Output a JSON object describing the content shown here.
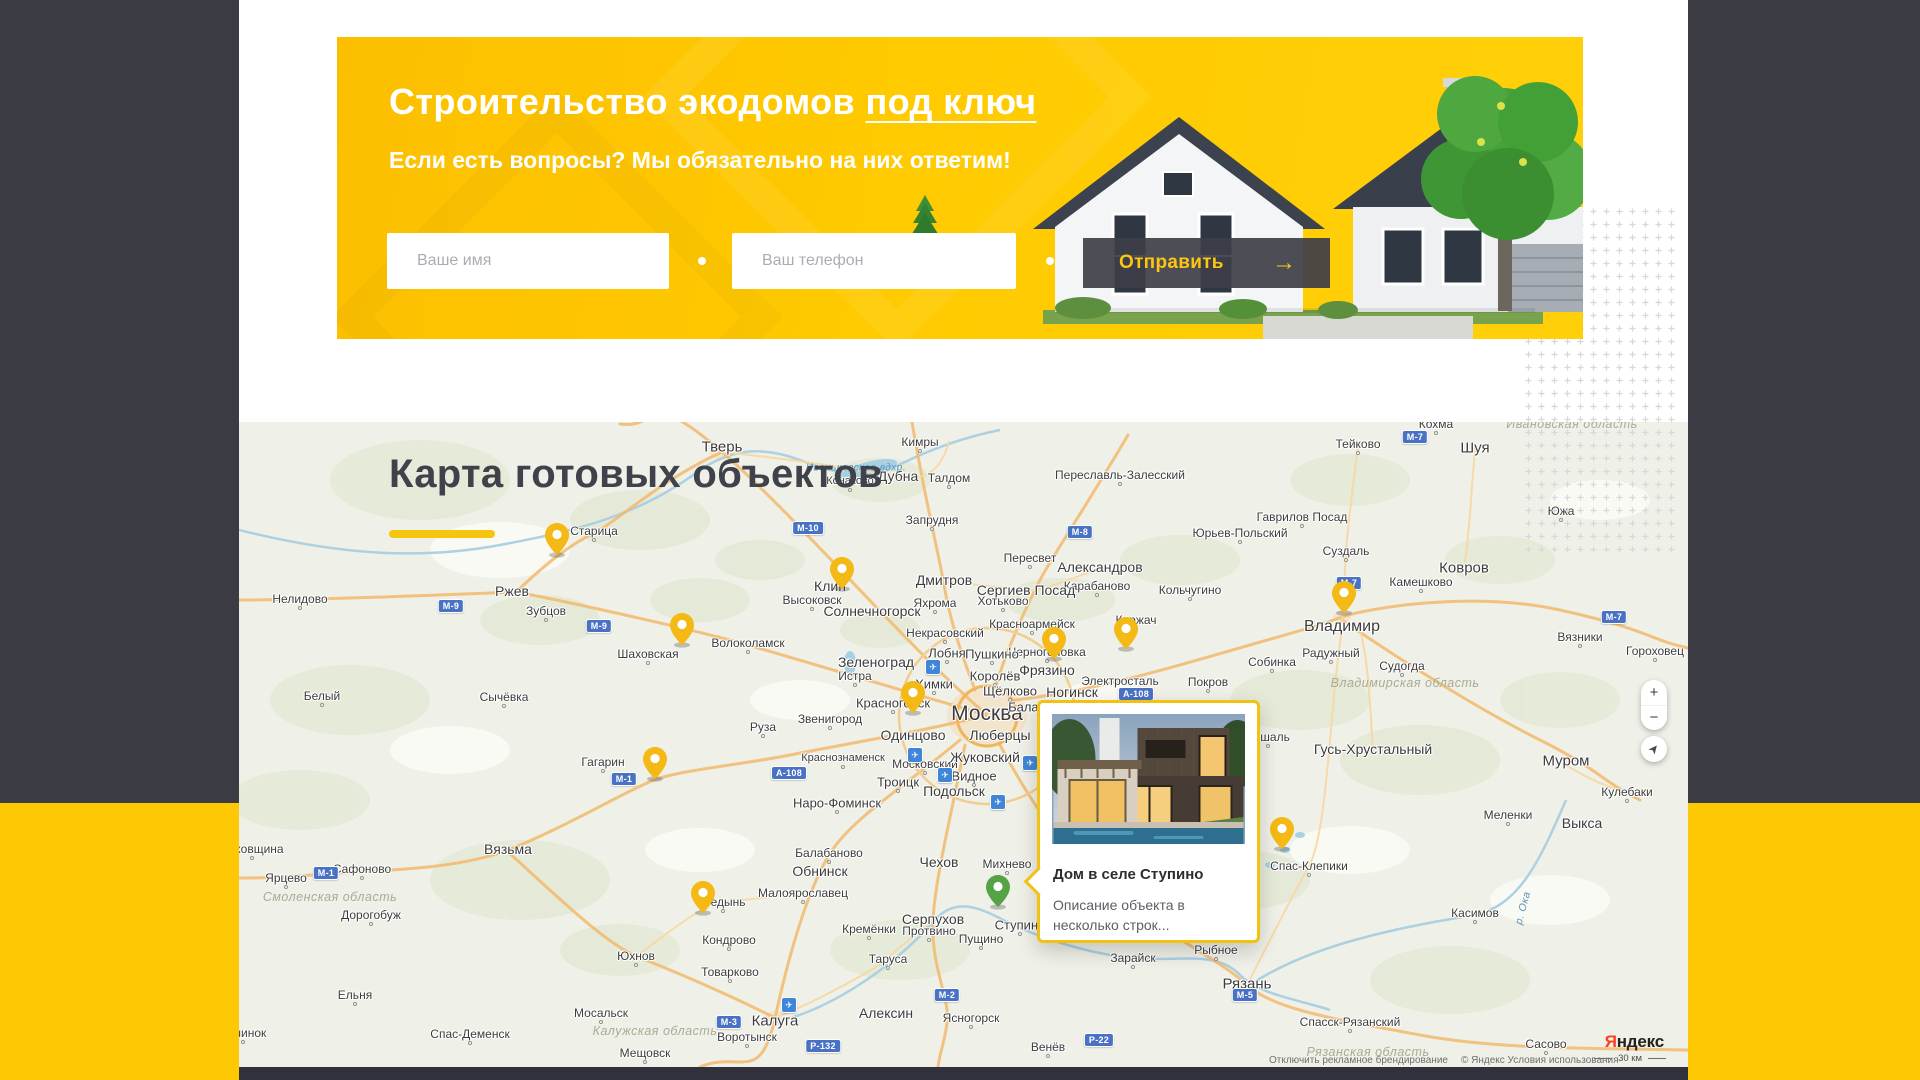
{
  "colors": {
    "accent_yellow": "#fdc400",
    "pin_yellow": "#f5b915",
    "pin_green": "#55a345",
    "dark": "#3a3b43",
    "button_dark": "#3e3e48"
  },
  "banner": {
    "title_prefix": "Строительство экодомов ",
    "title_underlined": "под ключ",
    "subtitle": "Если есть вопросы? Мы обязательно на них ответим!",
    "name_placeholder": "Ваше имя",
    "phone_placeholder": "Ваш телефон",
    "submit_label": "Отправить",
    "submit_arrow": "→"
  },
  "map_section": {
    "title": "Карта готовых объектов",
    "popup": {
      "title": "Дом в селе Ступино",
      "description": "Описание объекта в несколько строк..."
    },
    "controls": {
      "zoom_in": "+",
      "zoom_out": "−"
    },
    "attribution": {
      "branding": "Отключить рекламное брендирование",
      "terms": "© Яндекс Условия использования",
      "scale": "30 км",
      "logo_first": "Я",
      "logo_rest": "ндекс"
    },
    "cities": [
      {
        "t": "Тверь",
        "x": 722,
        "y": 447,
        "s": 15
      },
      {
        "t": "Кимры",
        "x": 920,
        "y": 442
      },
      {
        "t": "Дубна",
        "x": 898,
        "y": 476,
        "s": 14
      },
      {
        "t": "Талдом",
        "x": 949,
        "y": 478
      },
      {
        "t": "Конаково",
        "x": 850,
        "y": 481,
        "s": 11
      },
      {
        "t": "Запрудня",
        "x": 932,
        "y": 520
      },
      {
        "t": "Переславль-Залесский",
        "x": 1120,
        "y": 475
      },
      {
        "t": "Пересвет",
        "x": 1030,
        "y": 558
      },
      {
        "t": "Александров",
        "x": 1100,
        "y": 567,
        "s": 14
      },
      {
        "t": "Карабаново",
        "x": 1097,
        "y": 586
      },
      {
        "t": "Кольчугино",
        "x": 1190,
        "y": 590
      },
      {
        "t": "Юрьев-Польский",
        "x": 1240,
        "y": 533
      },
      {
        "t": "Киржач",
        "x": 1136,
        "y": 620
      },
      {
        "t": "Дмитров",
        "x": 944,
        "y": 580,
        "s": 14
      },
      {
        "t": "Сергиев Посад",
        "x": 1026,
        "y": 590,
        "s": 14
      },
      {
        "t": "Хотьково",
        "x": 1003,
        "y": 601
      },
      {
        "t": "Яхрома",
        "x": 935,
        "y": 603
      },
      {
        "t": "Высоковск",
        "x": 812,
        "y": 600
      },
      {
        "t": "Клин",
        "x": 830,
        "y": 586,
        "s": 14
      },
      {
        "t": "Солнечногорск",
        "x": 872,
        "y": 611,
        "s": 14
      },
      {
        "t": "Некрасовский",
        "x": 945,
        "y": 633
      },
      {
        "t": "Красноармейск",
        "x": 1032,
        "y": 624
      },
      {
        "t": "Черноголовка",
        "x": 1047,
        "y": 652
      },
      {
        "t": "Лобня",
        "x": 947,
        "y": 653,
        "s": 13
      },
      {
        "t": "Пушкино",
        "x": 992,
        "y": 654,
        "s": 13
      },
      {
        "t": "Фрязино",
        "x": 1047,
        "y": 670,
        "s": 14
      },
      {
        "t": "Зеленоград",
        "x": 876,
        "y": 662,
        "s": 14
      },
      {
        "t": "Истра",
        "x": 855,
        "y": 676
      },
      {
        "t": "Химки",
        "x": 934,
        "y": 684,
        "s": 13
      },
      {
        "t": "Королёв",
        "x": 995,
        "y": 676,
        "s": 13
      },
      {
        "t": "Щёлково",
        "x": 1010,
        "y": 691,
        "s": 13
      },
      {
        "t": "Ногинск",
        "x": 1072,
        "y": 692,
        "s": 14
      },
      {
        "t": "Электросталь",
        "x": 1120,
        "y": 681
      },
      {
        "t": "Покров",
        "x": 1208,
        "y": 682
      },
      {
        "t": "Красногорск",
        "x": 893,
        "y": 703,
        "s": 13
      },
      {
        "t": "Москва",
        "x": 987,
        "y": 714,
        "s": 21
      },
      {
        "t": "Звенигород",
        "x": 830,
        "y": 719
      },
      {
        "t": "Одинцово",
        "x": 913,
        "y": 735,
        "s": 14
      },
      {
        "t": "Люберцы",
        "x": 1000,
        "y": 735,
        "s": 14
      },
      {
        "t": "Балашиха",
        "x": 1039,
        "y": 707,
        "s": 13
      },
      {
        "t": "Краснознаменск",
        "x": 843,
        "y": 758,
        "s": 11
      },
      {
        "t": "Московский",
        "x": 925,
        "y": 764
      },
      {
        "t": "Жуковский",
        "x": 985,
        "y": 757,
        "s": 14
      },
      {
        "t": "Видное",
        "x": 974,
        "y": 776,
        "s": 13
      },
      {
        "t": "Троицк",
        "x": 898,
        "y": 782,
        "s": 13
      },
      {
        "t": "Подольск",
        "x": 954,
        "y": 791,
        "s": 14
      },
      {
        "t": "Наро-Фоминск",
        "x": 837,
        "y": 803,
        "s": 13
      },
      {
        "t": "Руза",
        "x": 763,
        "y": 727
      },
      {
        "t": "Волоколамск",
        "x": 748,
        "y": 643
      },
      {
        "t": "Шаховская",
        "x": 648,
        "y": 654
      },
      {
        "t": "Старица",
        "x": 594,
        "y": 531
      },
      {
        "t": "Ржев",
        "x": 512,
        "y": 591,
        "s": 14
      },
      {
        "t": "Зубцов",
        "x": 546,
        "y": 611
      },
      {
        "t": "Нелидово",
        "x": 300,
        "y": 599
      },
      {
        "t": "Белый",
        "x": 322,
        "y": 696
      },
      {
        "t": "Сычёвка",
        "x": 504,
        "y": 697
      },
      {
        "t": "Гагарин",
        "x": 603,
        "y": 762
      },
      {
        "t": "Вязьма",
        "x": 508,
        "y": 849,
        "s": 14
      },
      {
        "t": "Духовщина",
        "x": 252,
        "y": 849
      },
      {
        "t": "Ярцево",
        "x": 286,
        "y": 878
      },
      {
        "t": "Сафоново",
        "x": 362,
        "y": 869
      },
      {
        "t": "Дорогобуж",
        "x": 371,
        "y": 915
      },
      {
        "t": "Ельня",
        "x": 355,
        "y": 995
      },
      {
        "t": "Починок",
        "x": 243,
        "y": 1033
      },
      {
        "t": "Юхнов",
        "x": 636,
        "y": 956
      },
      {
        "t": "Мосальск",
        "x": 601,
        "y": 1013
      },
      {
        "t": "Мещовск",
        "x": 645,
        "y": 1053
      },
      {
        "t": "Спас-Деменск",
        "x": 470,
        "y": 1034
      },
      {
        "t": "Балабаново",
        "x": 829,
        "y": 853
      },
      {
        "t": "Обнинск",
        "x": 820,
        "y": 871,
        "s": 14
      },
      {
        "t": "Малоярославец",
        "x": 803,
        "y": 893
      },
      {
        "t": "Медынь",
        "x": 723,
        "y": 902
      },
      {
        "t": "Кондрово",
        "x": 729,
        "y": 940
      },
      {
        "t": "Товарково",
        "x": 730,
        "y": 972
      },
      {
        "t": "Калуга",
        "x": 775,
        "y": 1021,
        "s": 15
      },
      {
        "t": "Воротынск",
        "x": 747,
        "y": 1037
      },
      {
        "t": "Чехов",
        "x": 939,
        "y": 862,
        "s": 14
      },
      {
        "t": "Михнево",
        "x": 1007,
        "y": 864
      },
      {
        "t": "Серпухов",
        "x": 933,
        "y": 919,
        "s": 14
      },
      {
        "t": "Кремёнки",
        "x": 869,
        "y": 929
      },
      {
        "t": "Протвино",
        "x": 929,
        "y": 931
      },
      {
        "t": "Пущино",
        "x": 981,
        "y": 939
      },
      {
        "t": "Таруса",
        "x": 888,
        "y": 959
      },
      {
        "t": "Алексин",
        "x": 886,
        "y": 1013,
        "s": 14
      },
      {
        "t": "Ясногорск",
        "x": 971,
        "y": 1018
      },
      {
        "t": "Венёв",
        "x": 1048,
        "y": 1047
      },
      {
        "t": "Ступино",
        "x": 1020,
        "y": 925,
        "s": 13
      },
      {
        "t": "Зарайск",
        "x": 1133,
        "y": 958
      },
      {
        "t": "Рыбное",
        "x": 1216,
        "y": 950
      },
      {
        "t": "Рязань",
        "x": 1247,
        "y": 984,
        "s": 15
      },
      {
        "t": "Спасск-Рязанский",
        "x": 1350,
        "y": 1022
      },
      {
        "t": "Сасово",
        "x": 1546,
        "y": 1044
      },
      {
        "t": "Касимов",
        "x": 1475,
        "y": 913
      },
      {
        "t": "Спас-Клепики",
        "x": 1309,
        "y": 866
      },
      {
        "t": "Гусь-Хрустальный",
        "x": 1373,
        "y": 749,
        "s": 14
      },
      {
        "t": "Рошаль",
        "x": 1268,
        "y": 737
      },
      {
        "t": "Меленки",
        "x": 1508,
        "y": 815
      },
      {
        "t": "Муром",
        "x": 1566,
        "y": 761,
        "s": 15
      },
      {
        "t": "Кулебаки",
        "x": 1627,
        "y": 792
      },
      {
        "t": "Выкса",
        "x": 1582,
        "y": 823,
        "s": 14
      },
      {
        "t": "Владимир",
        "x": 1342,
        "y": 627,
        "s": 16
      },
      {
        "t": "Радужный",
        "x": 1331,
        "y": 653
      },
      {
        "t": "Собинка",
        "x": 1272,
        "y": 662
      },
      {
        "t": "Судогда",
        "x": 1402,
        "y": 666
      },
      {
        "t": "Суздаль",
        "x": 1346,
        "y": 551
      },
      {
        "t": "Камешково",
        "x": 1421,
        "y": 582
      },
      {
        "t": "Ковров",
        "x": 1464,
        "y": 568,
        "s": 15
      },
      {
        "t": "Вязники",
        "x": 1580,
        "y": 637
      },
      {
        "t": "Гороховец",
        "x": 1655,
        "y": 651
      },
      {
        "t": "Тейково",
        "x": 1358,
        "y": 444
      },
      {
        "t": "Шуя",
        "x": 1475,
        "y": 448,
        "s": 15
      },
      {
        "t": "Кохма",
        "x": 1436,
        "y": 424
      },
      {
        "t": "Южа",
        "x": 1561,
        "y": 511
      },
      {
        "t": "Гаврилов Посад",
        "x": 1302,
        "y": 517
      }
    ],
    "regions": [
      {
        "t": "Смоленская область",
        "x": 330,
        "y": 897
      },
      {
        "t": "Калужская область",
        "x": 655,
        "y": 1031
      },
      {
        "t": "Рязанская область",
        "x": 1368,
        "y": 1052
      },
      {
        "t": "Владимирская область",
        "x": 1405,
        "y": 683
      },
      {
        "t": "Ивановская область",
        "x": 1572,
        "y": 424
      },
      {
        "t": "Ивоньковское вдхр.",
        "x": 856,
        "y": 468,
        "c": "water",
        "s": 10
      },
      {
        "t": "р. Ока",
        "x": 1523,
        "y": 908,
        "c": "water",
        "r": -75
      }
    ],
    "badges": [
      {
        "t": "М-10",
        "x": 808,
        "y": 528
      },
      {
        "t": "М-9",
        "x": 451,
        "y": 606
      },
      {
        "t": "М-9",
        "x": 599,
        "y": 626
      },
      {
        "t": "М-8",
        "x": 1080,
        "y": 532
      },
      {
        "t": "М-7",
        "x": 1415,
        "y": 437
      },
      {
        "t": "М-7",
        "x": 1349,
        "y": 583
      },
      {
        "t": "М-7",
        "x": 1614,
        "y": 617
      },
      {
        "t": "А-108",
        "x": 789,
        "y": 773
      },
      {
        "t": "А-108",
        "x": 1136,
        "y": 694
      },
      {
        "t": "М-1",
        "x": 624,
        "y": 779
      },
      {
        "t": "М-1",
        "x": 326,
        "y": 873
      },
      {
        "t": "М-3",
        "x": 729,
        "y": 1022
      },
      {
        "t": "Р-132",
        "x": 823,
        "y": 1046
      },
      {
        "t": "М-2",
        "x": 947,
        "y": 995
      },
      {
        "t": "М-5",
        "x": 1245,
        "y": 995
      },
      {
        "t": "Р-22",
        "x": 1099,
        "y": 1040
      }
    ],
    "airports": [
      {
        "x": 933,
        "y": 667
      },
      {
        "x": 915,
        "y": 755
      },
      {
        "x": 945,
        "y": 775
      },
      {
        "x": 998,
        "y": 802
      },
      {
        "x": 1030,
        "y": 763
      },
      {
        "x": 789,
        "y": 1005
      }
    ],
    "pins": [
      {
        "x": 557,
        "y": 558
      },
      {
        "x": 842,
        "y": 592
      },
      {
        "x": 682,
        "y": 648
      },
      {
        "x": 1054,
        "y": 662
      },
      {
        "x": 1126,
        "y": 652
      },
      {
        "x": 913,
        "y": 716
      },
      {
        "x": 1344,
        "y": 616
      },
      {
        "x": 655,
        "y": 782
      },
      {
        "x": 1282,
        "y": 852
      },
      {
        "x": 703,
        "y": 916
      },
      {
        "x": 998,
        "y": 910,
        "c": "green"
      }
    ]
  }
}
